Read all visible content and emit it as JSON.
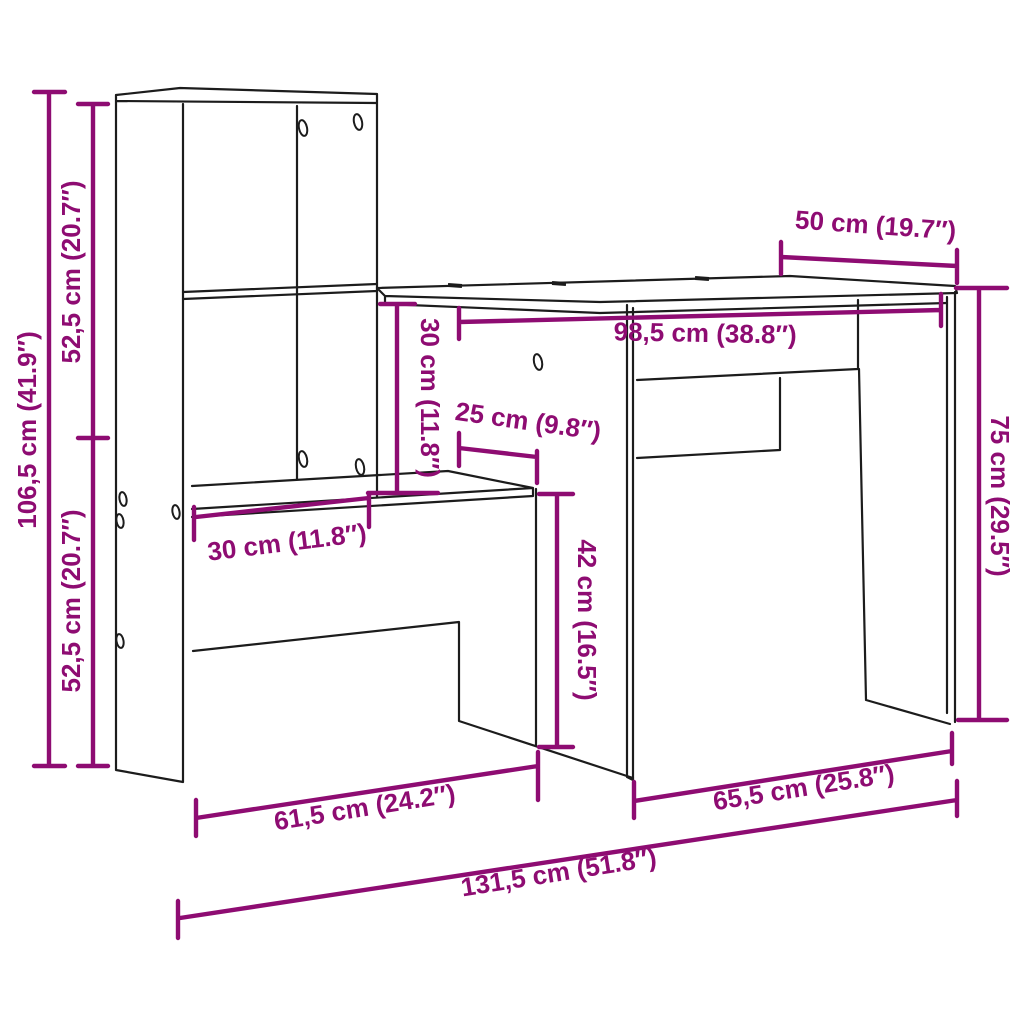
{
  "colors": {
    "dimension_magenta": "#8E0C72",
    "line_art_black": "#1C1C1C",
    "background": "#FFFFFF"
  },
  "dimensions": {
    "overall_height": "106,5 cm (41.9″)",
    "upper_section_height": "52,5 cm (20.7″)",
    "lower_section_height": "52,5 cm (20.7″)",
    "desk_depth": "50 cm (19.7″)",
    "desktop_width": "98,5 cm (38.8″)",
    "desktop_to_shelf_gap": "30 cm (11.8″)",
    "shelf_side_depth": "25 cm (9.8″)",
    "under_shelf_clearance": "42 cm (16.5″)",
    "desk_height": "75 cm (29.5″)",
    "shelf_depth": "30 cm (11.8″)",
    "shelf_unit_base_width": "61,5 cm (24.2″)",
    "desk_section_width": "65,5 cm (25.8″)",
    "overall_width": "131,5 cm (51.8″)"
  }
}
